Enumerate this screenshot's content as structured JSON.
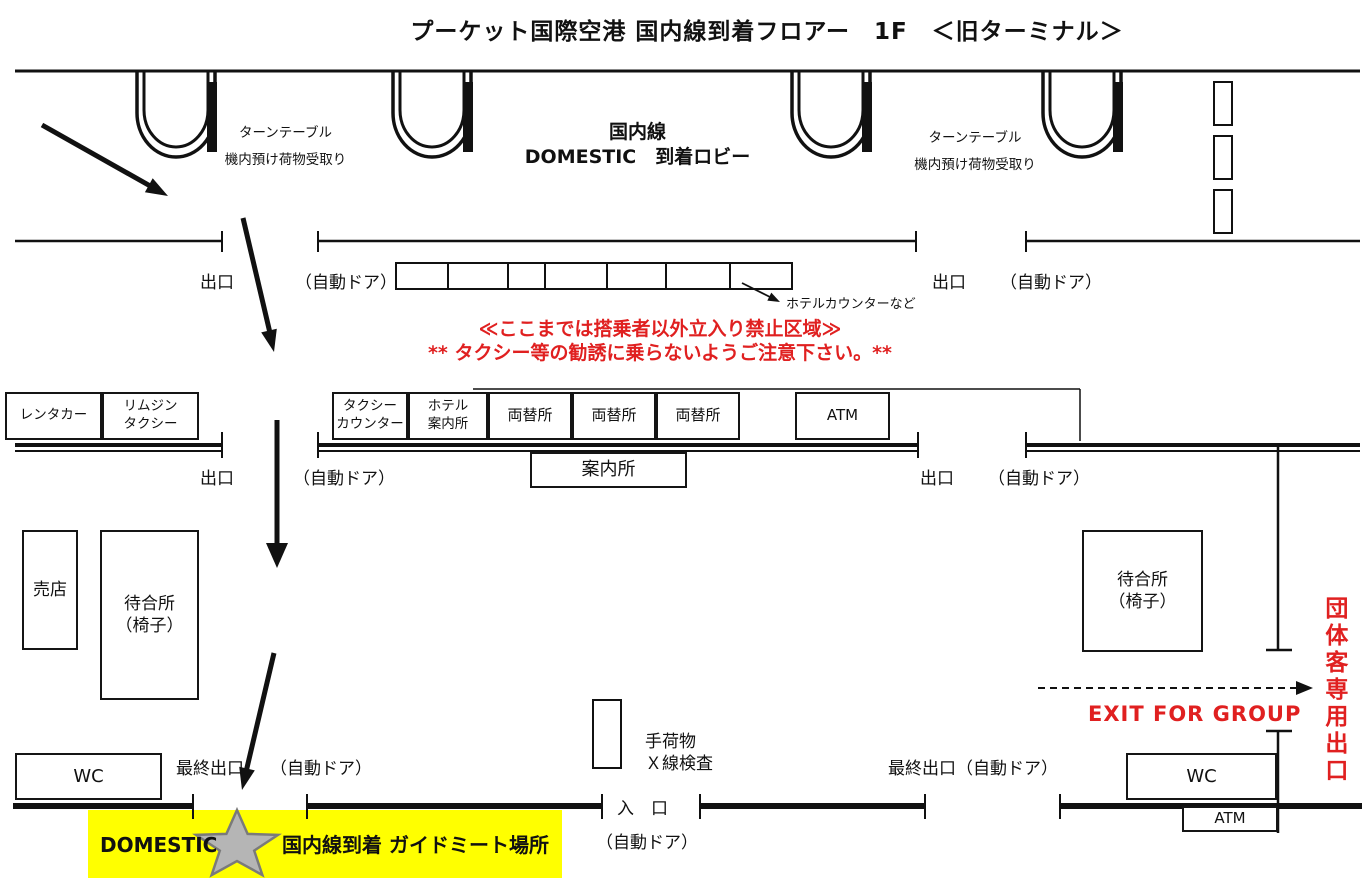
{
  "colors": {
    "red": "#e02020",
    "yellow": "#ffff00",
    "star_fill": "#b5b5b5",
    "star_stroke": "#7a7a7a"
  },
  "title": "プーケット国際空港 国内線到着フロアー　1F　＜旧ターミナル＞",
  "lobby": {
    "line1": "国内線",
    "line2": "DOMESTIC　到着ロビー"
  },
  "turntable": {
    "line1": "ターンテーブル",
    "line2": "機内預け荷物受取り"
  },
  "warning": {
    "line1": "≪ここまでは搭乗者以外立入り禁止区域≫",
    "line2": "** タクシー等の勧誘に乗らないようご注意下さい。**"
  },
  "labels": {
    "exit": "出口",
    "auto_door": "（自動ドア）",
    "final_exit": "最終出口",
    "final_exit_auto_door": "最終出口（自動ドア）",
    "entrance": "入　口",
    "hotel_counter_note": "ホテルカウンターなど",
    "xray_line1": "手荷物",
    "xray_line2": "Ｘ線検査",
    "info_desk": "案内所",
    "exit_for_group": "EXIT FOR GROUP",
    "group_exit_vertical": "団体客専用出口"
  },
  "booths": {
    "rentacar": "レンタカー",
    "limousine_line1": "リムジン",
    "limousine_line2": "タクシー",
    "taxi_counter_line1": "タクシー",
    "taxi_counter_line2": "カウンター",
    "hotel_info_line1": "ホテル",
    "hotel_info_line2": "案内所",
    "exchange": "両替所",
    "atm": "ATM",
    "shop": "売店",
    "waiting_line1": "待合所",
    "waiting_line2": "（椅子）",
    "wc": "WC"
  },
  "meeting_point": {
    "domestic": "DOMESTIC",
    "label": "国内線到着 ガイドミート場所"
  }
}
